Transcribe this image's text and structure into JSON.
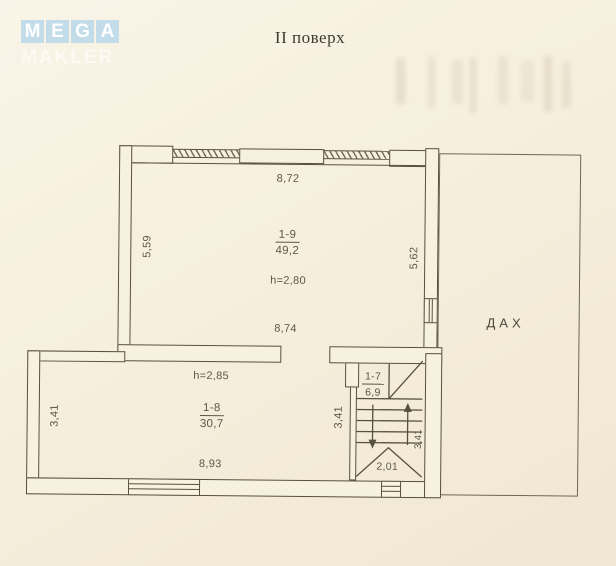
{
  "logo": {
    "letters": [
      "M",
      "E",
      "G",
      "A"
    ],
    "watermark": "MAKLER",
    "tile_color": "#c2dde9"
  },
  "title": "II поверх",
  "roof_label": "ДАХ",
  "rooms": {
    "room_1_9": {
      "number": "1-9",
      "area": "49,2",
      "height": "h=2,80",
      "dim_top": "8,72",
      "dim_bottom": "8,74",
      "dim_left": "5,59",
      "dim_right": "5,62"
    },
    "room_1_8": {
      "number": "1-8",
      "area": "30,7",
      "height": "h=2,85",
      "dim_bottom": "8,93",
      "dim_left": "3,41",
      "dim_right": "3,41"
    },
    "stairwell_1_7": {
      "number": "1-7",
      "area": "6,9",
      "dim_bottom": "2,01",
      "dim_side": "3,41"
    }
  },
  "colors": {
    "paper": "#f6efde",
    "line": "#57503f",
    "text": "#5d5546",
    "logo_tile": "#c2dde9"
  }
}
